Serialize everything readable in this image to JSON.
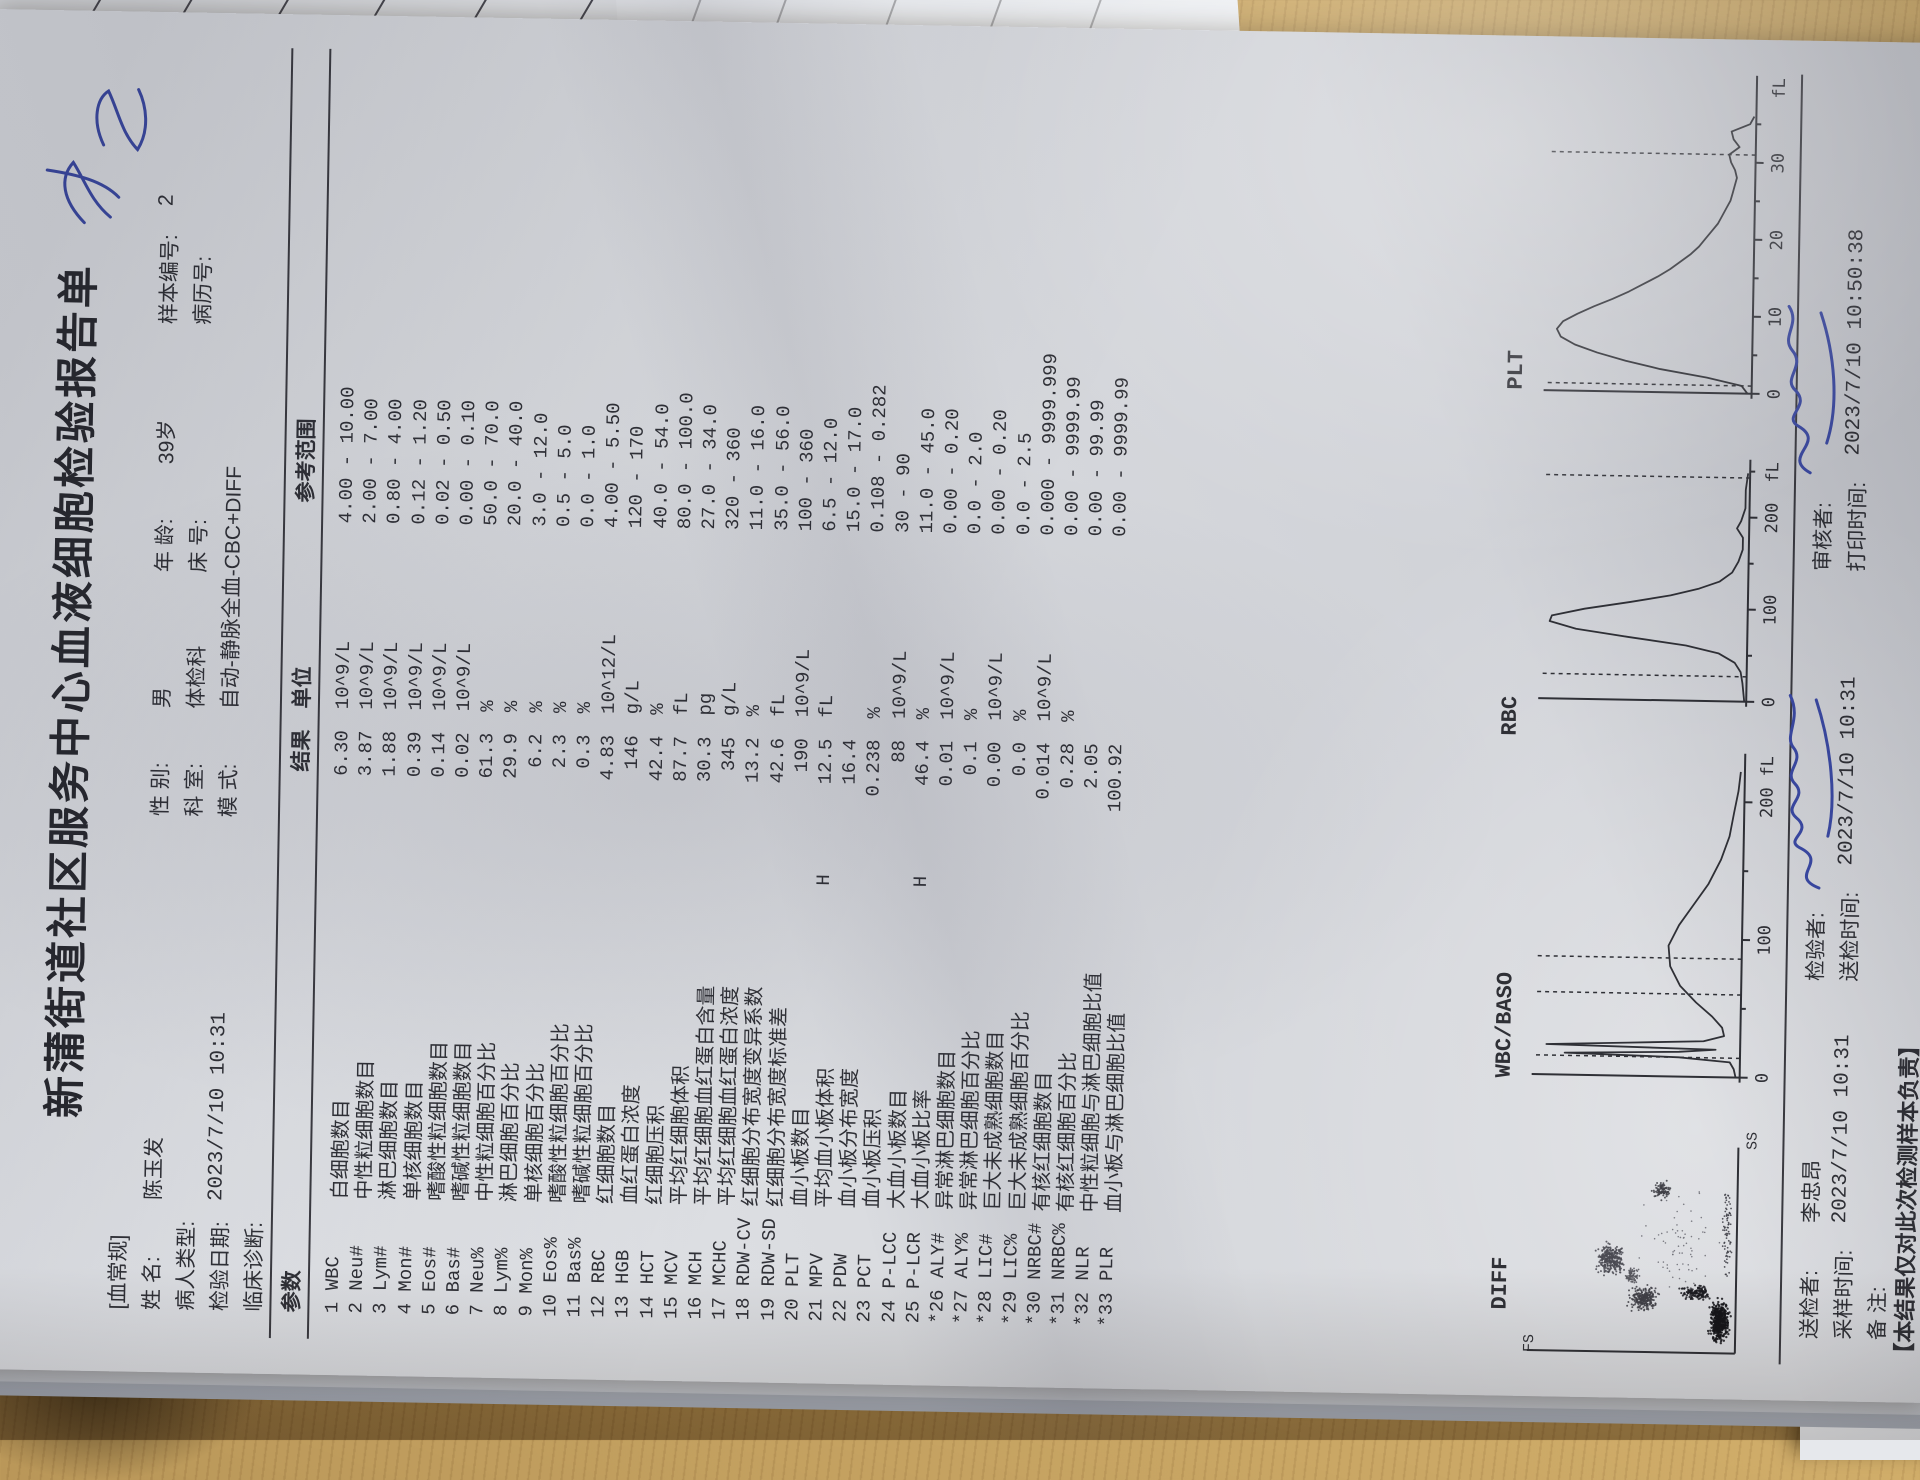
{
  "title": "新蒲街道社区服务中心血液细胞检验报告单",
  "header": {
    "tag": "[血常规]",
    "name_l": "姓  名:",
    "name_v": "陈玉发",
    "sex_l": "性  别:",
    "sex_v": "男",
    "age_l": "年  龄:",
    "age_v": "39岁",
    "sample_l": "样本编号:",
    "sample_v": "2",
    "ptype_l": "病人类型:",
    "ptype_v": "",
    "dept_l": "科  室:",
    "dept_v": "体检科",
    "bed_l": "床  号:",
    "bed_v": "",
    "record_l": "病历号:",
    "record_v": "",
    "date_l": "检验日期:",
    "date_v": "2023/7/10  10:31",
    "mode_l": "模  式:",
    "mode_v": "自动-静脉全血-CBC+DIFF",
    "diag_l": "临床诊断:",
    "diag_v": ""
  },
  "table": {
    "headers": {
      "param": "参数",
      "result": "结果",
      "unit": "单位",
      "range": "参考范围"
    },
    "rows": [
      {
        "code": "1 WBC",
        "name": "白细胞数目",
        "flag": "",
        "result": "6.30",
        "unit": "10^9/L",
        "range": "4.00 - 10.00"
      },
      {
        "code": "2 Neu#",
        "name": "中性粒细胞数目",
        "flag": "",
        "result": "3.87",
        "unit": "10^9/L",
        "range": "2.00 - 7.00"
      },
      {
        "code": "3 Lym#",
        "name": "淋巴细胞数目",
        "flag": "",
        "result": "1.88",
        "unit": "10^9/L",
        "range": "0.80 - 4.00"
      },
      {
        "code": "4 Mon#",
        "name": "单核细胞数目",
        "flag": "",
        "result": "0.39",
        "unit": "10^9/L",
        "range": "0.12 - 1.20"
      },
      {
        "code": "5 Eos#",
        "name": "嗜酸性粒细胞数目",
        "flag": "",
        "result": "0.14",
        "unit": "10^9/L",
        "range": "0.02 - 0.50"
      },
      {
        "code": "6 Bas#",
        "name": "嗜碱性粒细胞数目",
        "flag": "",
        "result": "0.02",
        "unit": "10^9/L",
        "range": "0.00 - 0.10"
      },
      {
        "code": "7 Neu%",
        "name": "中性粒细胞百分比",
        "flag": "",
        "result": "61.3",
        "unit": "%",
        "range": "50.0 - 70.0"
      },
      {
        "code": "8 Lym%",
        "name": "淋巴细胞百分比",
        "flag": "",
        "result": "29.9",
        "unit": "%",
        "range": "20.0 - 40.0"
      },
      {
        "code": "9 Mon%",
        "name": "单核细胞百分比",
        "flag": "",
        "result": "6.2",
        "unit": "%",
        "range": "3.0 - 12.0"
      },
      {
        "code": "10 Eos%",
        "name": "嗜酸性粒细胞百分比",
        "flag": "",
        "result": "2.3",
        "unit": "%",
        "range": "0.5 - 5.0"
      },
      {
        "code": "11 Bas%",
        "name": "嗜碱性粒细胞百分比",
        "flag": "",
        "result": "0.3",
        "unit": "%",
        "range": "0.0 - 1.0"
      },
      {
        "code": "12 RBC",
        "name": "红细胞数目",
        "flag": "",
        "result": "4.83",
        "unit": "10^12/L",
        "range": "4.00 - 5.50"
      },
      {
        "code": "13 HGB",
        "name": "血红蛋白浓度",
        "flag": "",
        "result": "146",
        "unit": "g/L",
        "range": "120 - 170"
      },
      {
        "code": "14 HCT",
        "name": "红细胞压积",
        "flag": "",
        "result": "42.4",
        "unit": "%",
        "range": "40.0 - 54.0"
      },
      {
        "code": "15 MCV",
        "name": "平均红细胞体积",
        "flag": "",
        "result": "87.7",
        "unit": "fL",
        "range": "80.0 - 100.0"
      },
      {
        "code": "16 MCH",
        "name": "平均红细胞血红蛋白含量",
        "flag": "",
        "result": "30.3",
        "unit": "pg",
        "range": "27.0 - 34.0"
      },
      {
        "code": "17 MCHC",
        "name": "平均红细胞血红蛋白浓度",
        "flag": "",
        "result": "345",
        "unit": "g/L",
        "range": "320 - 360"
      },
      {
        "code": "18 RDW-CV",
        "name": "红细胞分布宽度变异系数",
        "flag": "",
        "result": "13.2",
        "unit": "%",
        "range": "11.0 - 16.0"
      },
      {
        "code": "19 RDW-SD",
        "name": "红细胞分布宽度标准差",
        "flag": "",
        "result": "42.6",
        "unit": "fL",
        "range": "35.0 - 56.0"
      },
      {
        "code": "20 PLT",
        "name": "血小板数目",
        "flag": "",
        "result": "190",
        "unit": "10^9/L",
        "range": "100 - 360"
      },
      {
        "code": "21 MPV",
        "name": "平均血小板体积",
        "flag": "H",
        "result": "12.5",
        "unit": "fL",
        "range": "6.5 - 12.0"
      },
      {
        "code": "22 PDW",
        "name": "血小板分布宽度",
        "flag": "",
        "result": "16.4",
        "unit": "",
        "range": "15.0 - 17.0"
      },
      {
        "code": "23 PCT",
        "name": "血小板压积",
        "flag": "",
        "result": "0.238",
        "unit": "%",
        "range": "0.108 - 0.282"
      },
      {
        "code": "24 P-LCC",
        "name": "大血小板数目",
        "flag": "",
        "result": "88",
        "unit": "10^9/L",
        "range": "30 - 90"
      },
      {
        "code": "25 P-LCR",
        "name": "大血小板比率",
        "flag": "H",
        "result": "46.4",
        "unit": "%",
        "range": "11.0 - 45.0"
      },
      {
        "code": "*26 ALY#",
        "name": "异常淋巴细胞数目",
        "flag": "",
        "result": "0.01",
        "unit": "10^9/L",
        "range": "0.00 - 0.20"
      },
      {
        "code": "*27 ALY%",
        "name": "异常淋巴细胞百分比",
        "flag": "",
        "result": "0.1",
        "unit": "%",
        "range": "0.0 - 2.0"
      },
      {
        "code": "*28 LIC#",
        "name": "巨大未成熟细胞数目",
        "flag": "",
        "result": "0.00",
        "unit": "10^9/L",
        "range": "0.00 - 0.20"
      },
      {
        "code": "*29 LIC%",
        "name": "巨大未成熟细胞百分比",
        "flag": "",
        "result": "0.0",
        "unit": "%",
        "range": "0.0 - 2.5"
      },
      {
        "code": "*30 NRBC#",
        "name": "有核红细胞数目",
        "flag": "",
        "result": "0.014",
        "unit": "10^9/L",
        "range": "0.000 - 9999.999"
      },
      {
        "code": "*31 NRBC%",
        "name": "有核红细胞百分比",
        "flag": "",
        "result": "0.28",
        "unit": "%",
        "range": "0.00 - 9999.99"
      },
      {
        "code": "*32 NLR",
        "name": "中性粒细胞与淋巴细胞比值",
        "flag": "",
        "result": "2.05",
        "unit": "",
        "range": "0.00 - 99.99"
      },
      {
        "code": "*33 PLR",
        "name": "血小板与淋巴细胞比值",
        "flag": "",
        "result": "100.92",
        "unit": "",
        "range": "0.00 - 9999.99"
      }
    ]
  },
  "chart_data": [
    {
      "id": "diff",
      "type": "scatter",
      "title": "DIFF",
      "xlabel": "SS",
      "ylabel": "FS",
      "clusters": [
        {
          "name": "debris",
          "cx": 0.16,
          "cy": 0.08,
          "rx": 0.13,
          "ry": 0.06,
          "n": 420,
          "color": "#15151a",
          "size": 2.4
        },
        {
          "name": "debris-arc",
          "cx": 0.3,
          "cy": 0.2,
          "rx": 0.05,
          "ry": 0.1,
          "n": 140,
          "color": "#1c1c22",
          "size": 2.2
        },
        {
          "name": "lymphocytes",
          "cx": 0.27,
          "cy": 0.46,
          "rx": 0.075,
          "ry": 0.095,
          "n": 260,
          "color": "#3f3f46",
          "size": 2.0
        },
        {
          "name": "monocytes",
          "cx": 0.38,
          "cy": 0.52,
          "rx": 0.05,
          "ry": 0.05,
          "n": 80,
          "color": "#55555c",
          "size": 1.8
        },
        {
          "name": "neutrophils",
          "cx": 0.46,
          "cy": 0.63,
          "rx": 0.105,
          "ry": 0.085,
          "n": 300,
          "color": "#4a4a52",
          "size": 2.0
        },
        {
          "name": "eosinophils",
          "cx": 0.81,
          "cy": 0.38,
          "rx": 0.055,
          "ry": 0.06,
          "n": 90,
          "color": "#3f3f46",
          "size": 2.0
        },
        {
          "name": "bottom-trail",
          "cx": 0.6,
          "cy": 0.05,
          "rx": 0.3,
          "ry": 0.035,
          "n": 80,
          "color": "#3a3a42",
          "size": 1.8
        },
        {
          "name": "noise",
          "cx": 0.55,
          "cy": 0.3,
          "rx": 0.35,
          "ry": 0.24,
          "n": 70,
          "color": "#6a6a72",
          "size": 1.6
        }
      ]
    },
    {
      "id": "wbc",
      "type": "histogram",
      "title": "WBC/BASO",
      "xmax": 228,
      "ticks": [
        0,
        100,
        200
      ],
      "unit": "fL",
      "dashed": [
        {
          "x": 14,
          "h": 1.0
        },
        {
          "x": 60,
          "h": 1.0
        },
        {
          "x": 86,
          "h": 1.0
        }
      ],
      "curve": [
        [
          0,
          0.02
        ],
        [
          6,
          0.03
        ],
        [
          11,
          0.05
        ],
        [
          14,
          0.3
        ],
        [
          16,
          0.86
        ],
        [
          18,
          0.3
        ],
        [
          20,
          0.12
        ],
        [
          22,
          0.95
        ],
        [
          24,
          0.55
        ],
        [
          26,
          0.18
        ],
        [
          30,
          0.08
        ],
        [
          36,
          0.09
        ],
        [
          44,
          0.14
        ],
        [
          54,
          0.22
        ],
        [
          66,
          0.3
        ],
        [
          80,
          0.35
        ],
        [
          95,
          0.36
        ],
        [
          110,
          0.31
        ],
        [
          125,
          0.24
        ],
        [
          140,
          0.17
        ],
        [
          158,
          0.11
        ],
        [
          175,
          0.07
        ],
        [
          192,
          0.05
        ],
        [
          208,
          0.03
        ],
        [
          222,
          0.02
        ]
      ]
    },
    {
      "id": "rbc",
      "type": "histogram",
      "title": "RBC",
      "xmax": 252,
      "ticks": [
        0,
        100,
        200
      ],
      "unit": "fL",
      "dashed": [
        {
          "x": 27,
          "h": 1.0
        },
        {
          "x": 243,
          "h": 1.0
        }
      ],
      "curve": [
        [
          0,
          0.01
        ],
        [
          20,
          0.02
        ],
        [
          32,
          0.03
        ],
        [
          42,
          0.06
        ],
        [
          52,
          0.14
        ],
        [
          60,
          0.3
        ],
        [
          68,
          0.58
        ],
        [
          76,
          0.84
        ],
        [
          84,
          0.97
        ],
        [
          90,
          0.96
        ],
        [
          98,
          0.8
        ],
        [
          106,
          0.58
        ],
        [
          114,
          0.38
        ],
        [
          122,
          0.24
        ],
        [
          130,
          0.14
        ],
        [
          140,
          0.08
        ],
        [
          152,
          0.05
        ],
        [
          165,
          0.03
        ],
        [
          178,
          0.03
        ],
        [
          188,
          0.06
        ],
        [
          196,
          0.04
        ],
        [
          210,
          0.02
        ],
        [
          230,
          0.02
        ],
        [
          248,
          0.01
        ]
      ]
    },
    {
      "id": "plt",
      "type": "histogram",
      "title": "PLT",
      "xmax": 40,
      "ticks": [
        0,
        10,
        20,
        30
      ],
      "unit": "fL",
      "dashed": [
        {
          "x": 1,
          "h": 1.0
        },
        {
          "x": 31,
          "h": 1.0
        }
      ],
      "curve": [
        [
          0,
          0.02
        ],
        [
          1,
          0.05
        ],
        [
          2,
          0.22
        ],
        [
          3,
          0.45
        ],
        [
          4,
          0.62
        ],
        [
          5,
          0.76
        ],
        [
          6,
          0.87
        ],
        [
          7,
          0.94
        ],
        [
          8,
          0.96
        ],
        [
          9,
          0.93
        ],
        [
          10,
          0.86
        ],
        [
          11,
          0.78
        ],
        [
          12,
          0.69
        ],
        [
          13,
          0.61
        ],
        [
          14,
          0.54
        ],
        [
          15,
          0.47
        ],
        [
          16,
          0.41
        ],
        [
          17,
          0.36
        ],
        [
          18,
          0.31
        ],
        [
          19,
          0.27
        ],
        [
          20,
          0.24
        ],
        [
          21,
          0.21
        ],
        [
          22,
          0.18
        ],
        [
          23,
          0.16
        ],
        [
          24,
          0.14
        ],
        [
          25,
          0.12
        ],
        [
          26,
          0.11
        ],
        [
          27,
          0.1
        ],
        [
          28,
          0.09
        ],
        [
          29,
          0.1
        ],
        [
          30,
          0.12
        ],
        [
          31,
          0.13
        ],
        [
          32,
          0.08
        ],
        [
          33,
          0.11
        ],
        [
          34,
          0.12
        ],
        [
          35,
          0.03
        ],
        [
          36,
          0.01
        ]
      ]
    }
  ],
  "footer": {
    "sender_l": "送检者:",
    "sender_v": "李忠昂",
    "tester_l": "检验者:",
    "reviewer_l": "审核者:",
    "sample_t_l": "采样时间:",
    "sample_t_v": "2023/7/10  10:31",
    "send_t_l": "送检时间:",
    "send_t_v": "2023/7/10  10:31",
    "print_t_l": "打印时间:",
    "print_t_v": "2023/7/10  10:50:38",
    "note_l": "备  注:",
    "disclaimer": "【本结果仅对此次检测样本负责】"
  },
  "background": {
    "form_cells": [
      "日化促",
      "日化促销",
      "化促销员",
      "促销员",
      "销员"
    ],
    "names": [
      "余",
      "张华",
      "鲁景玉"
    ]
  },
  "colors": {
    "ink": "#2f3036",
    "blue_ink": "#3a49a5",
    "paper": "#dadce0",
    "wood": "#c69f58"
  }
}
